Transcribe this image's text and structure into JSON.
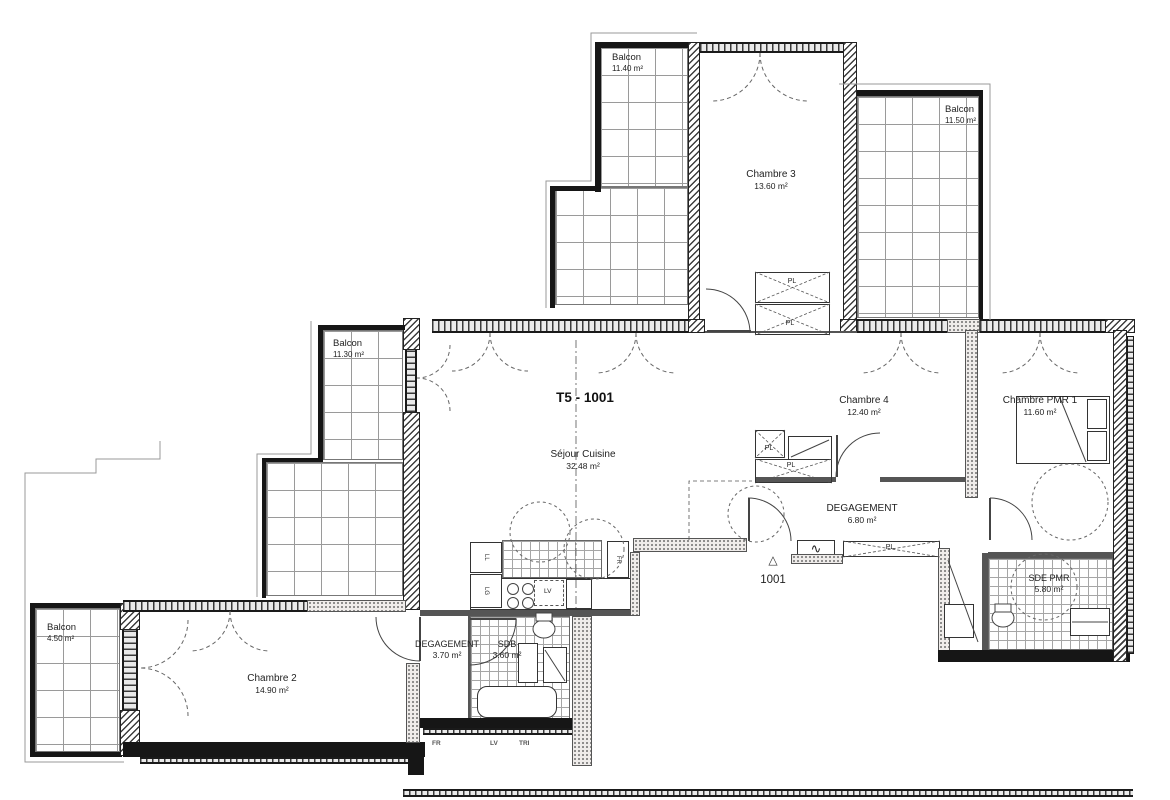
{
  "plan": {
    "title": "T5 - 1001"
  },
  "entry": {
    "marker": "△",
    "number": "1001"
  },
  "rooms": {
    "balcon_top_left": {
      "name": "Balcon",
      "area": "11.40 m²"
    },
    "balcon_top_right": {
      "name": "Balcon",
      "area": "11.50 m²"
    },
    "balcon_mid_left": {
      "name": "Balcon",
      "area": "11.30 m²"
    },
    "balcon_bottom_left": {
      "name": "Balcon",
      "area": "4.50 m²"
    },
    "chambre2": {
      "name": "Chambre 2",
      "area": "14.90 m²"
    },
    "chambre3": {
      "name": "Chambre 3",
      "area": "13.60 m²"
    },
    "chambre4": {
      "name": "Chambre 4",
      "area": "12.40 m²"
    },
    "chambre_pmr1": {
      "name": "Chambre PMR 1",
      "area": "11.60 m²"
    },
    "sejour": {
      "name": "Séjour Cuisine",
      "area": "32.48 m²"
    },
    "degagement_main": {
      "name": "DEGAGEMENT",
      "area": "6.80 m²"
    },
    "degagement_small": {
      "name": "DEGAGEMENT",
      "area": "3.70 m²"
    },
    "sdb": {
      "name": "SDB",
      "area": "3.60 m²"
    },
    "sde_pmr": {
      "name": "SDE PMR",
      "area": "5.80 m²"
    }
  },
  "closet_label": "PL",
  "radiator_symbol": "∿",
  "appliances": {
    "fridge": "FR",
    "dishwasher": "LV",
    "washer": "LL",
    "dryer": "LG"
  },
  "annotations": {
    "fr": "FR",
    "lv": "LV",
    "tri": "TRI"
  }
}
